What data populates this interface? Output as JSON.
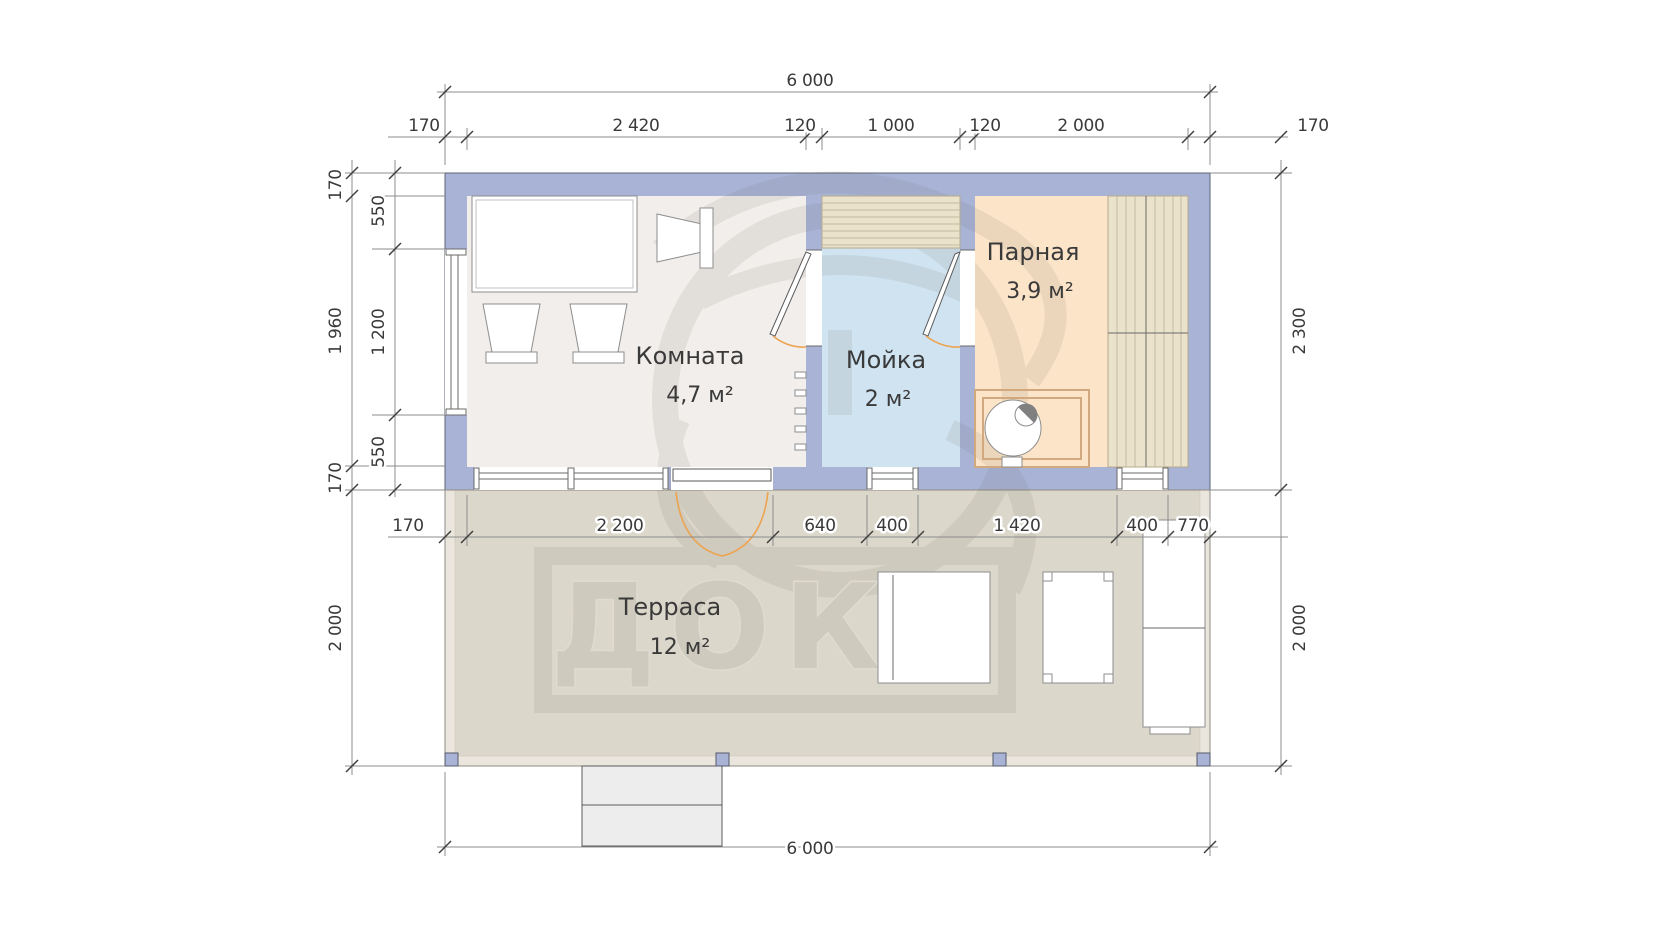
{
  "plan_type": "floor-plan",
  "rooms": {
    "komnata": {
      "label": "Комната",
      "area": "4,7 м²"
    },
    "moyka": {
      "label": "Мойка",
      "area": "2 м²"
    },
    "parnaya": {
      "label": "Парная",
      "area": "3,9 м²"
    },
    "terrace": {
      "label": "Терраса",
      "area": "12 м²"
    }
  },
  "dimensions": {
    "overall_top": "6 000",
    "top_row": [
      "170",
      "2 420",
      "120",
      "1 000",
      "120",
      "2 000",
      "170"
    ],
    "left_outer": [
      "170",
      "1 960",
      "170",
      "2 000"
    ],
    "left_inner": [
      "550",
      "1 200",
      "550"
    ],
    "right": [
      "2 300",
      "2 000"
    ],
    "middle_row": [
      "170",
      "2 200",
      "640",
      "400",
      "1 420",
      "400",
      "770"
    ],
    "overall_bottom": "6 000"
  },
  "watermark": {
    "text": "ДОКА"
  },
  "colors": {
    "wall": "#a8b3d6",
    "floor_komnata": "#f1eeec",
    "floor_moyka": "#cfe3f1",
    "floor_parnaya": "#fce4c8",
    "floor_terrace": "#dcd7cb",
    "door_swing": "#eda450",
    "dimension_text": "#3a3a3a"
  }
}
